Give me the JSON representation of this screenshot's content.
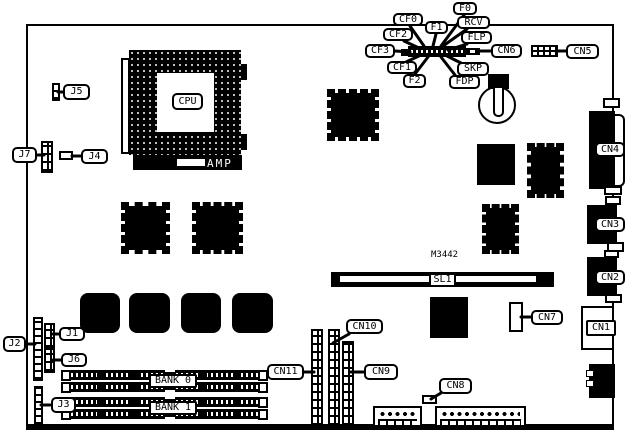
{
  "labels": {
    "f0": "F0",
    "f1": "F1",
    "f2": "F2",
    "cf0": "CF0",
    "cf1": "CF1",
    "cf2": "CF2",
    "cf3": "CF3",
    "rcv": "RCV",
    "flp": "FLP",
    "skp": "SKP",
    "fdp": "FDP",
    "cn1": "CN1",
    "cn2": "CN2",
    "cn3": "CN3",
    "cn4": "CN4",
    "cn5": "CN5",
    "cn6": "CN6",
    "cn7": "CN7",
    "cn8": "CN8",
    "cn9": "CN9",
    "cn10": "CN10",
    "cn11": "CN11",
    "j1": "J1",
    "j2": "J2",
    "j3": "J3",
    "j4": "J4",
    "j5": "J5",
    "j6": "J6",
    "j7": "J7",
    "cpu": "CPU",
    "amp": "AMP",
    "sl1": "SL1",
    "m3442": "M3442",
    "bank0": "BANK 0",
    "bank1": "BANK 1"
  },
  "colors": {
    "ink": "#000000",
    "paper": "#ffffff"
  }
}
